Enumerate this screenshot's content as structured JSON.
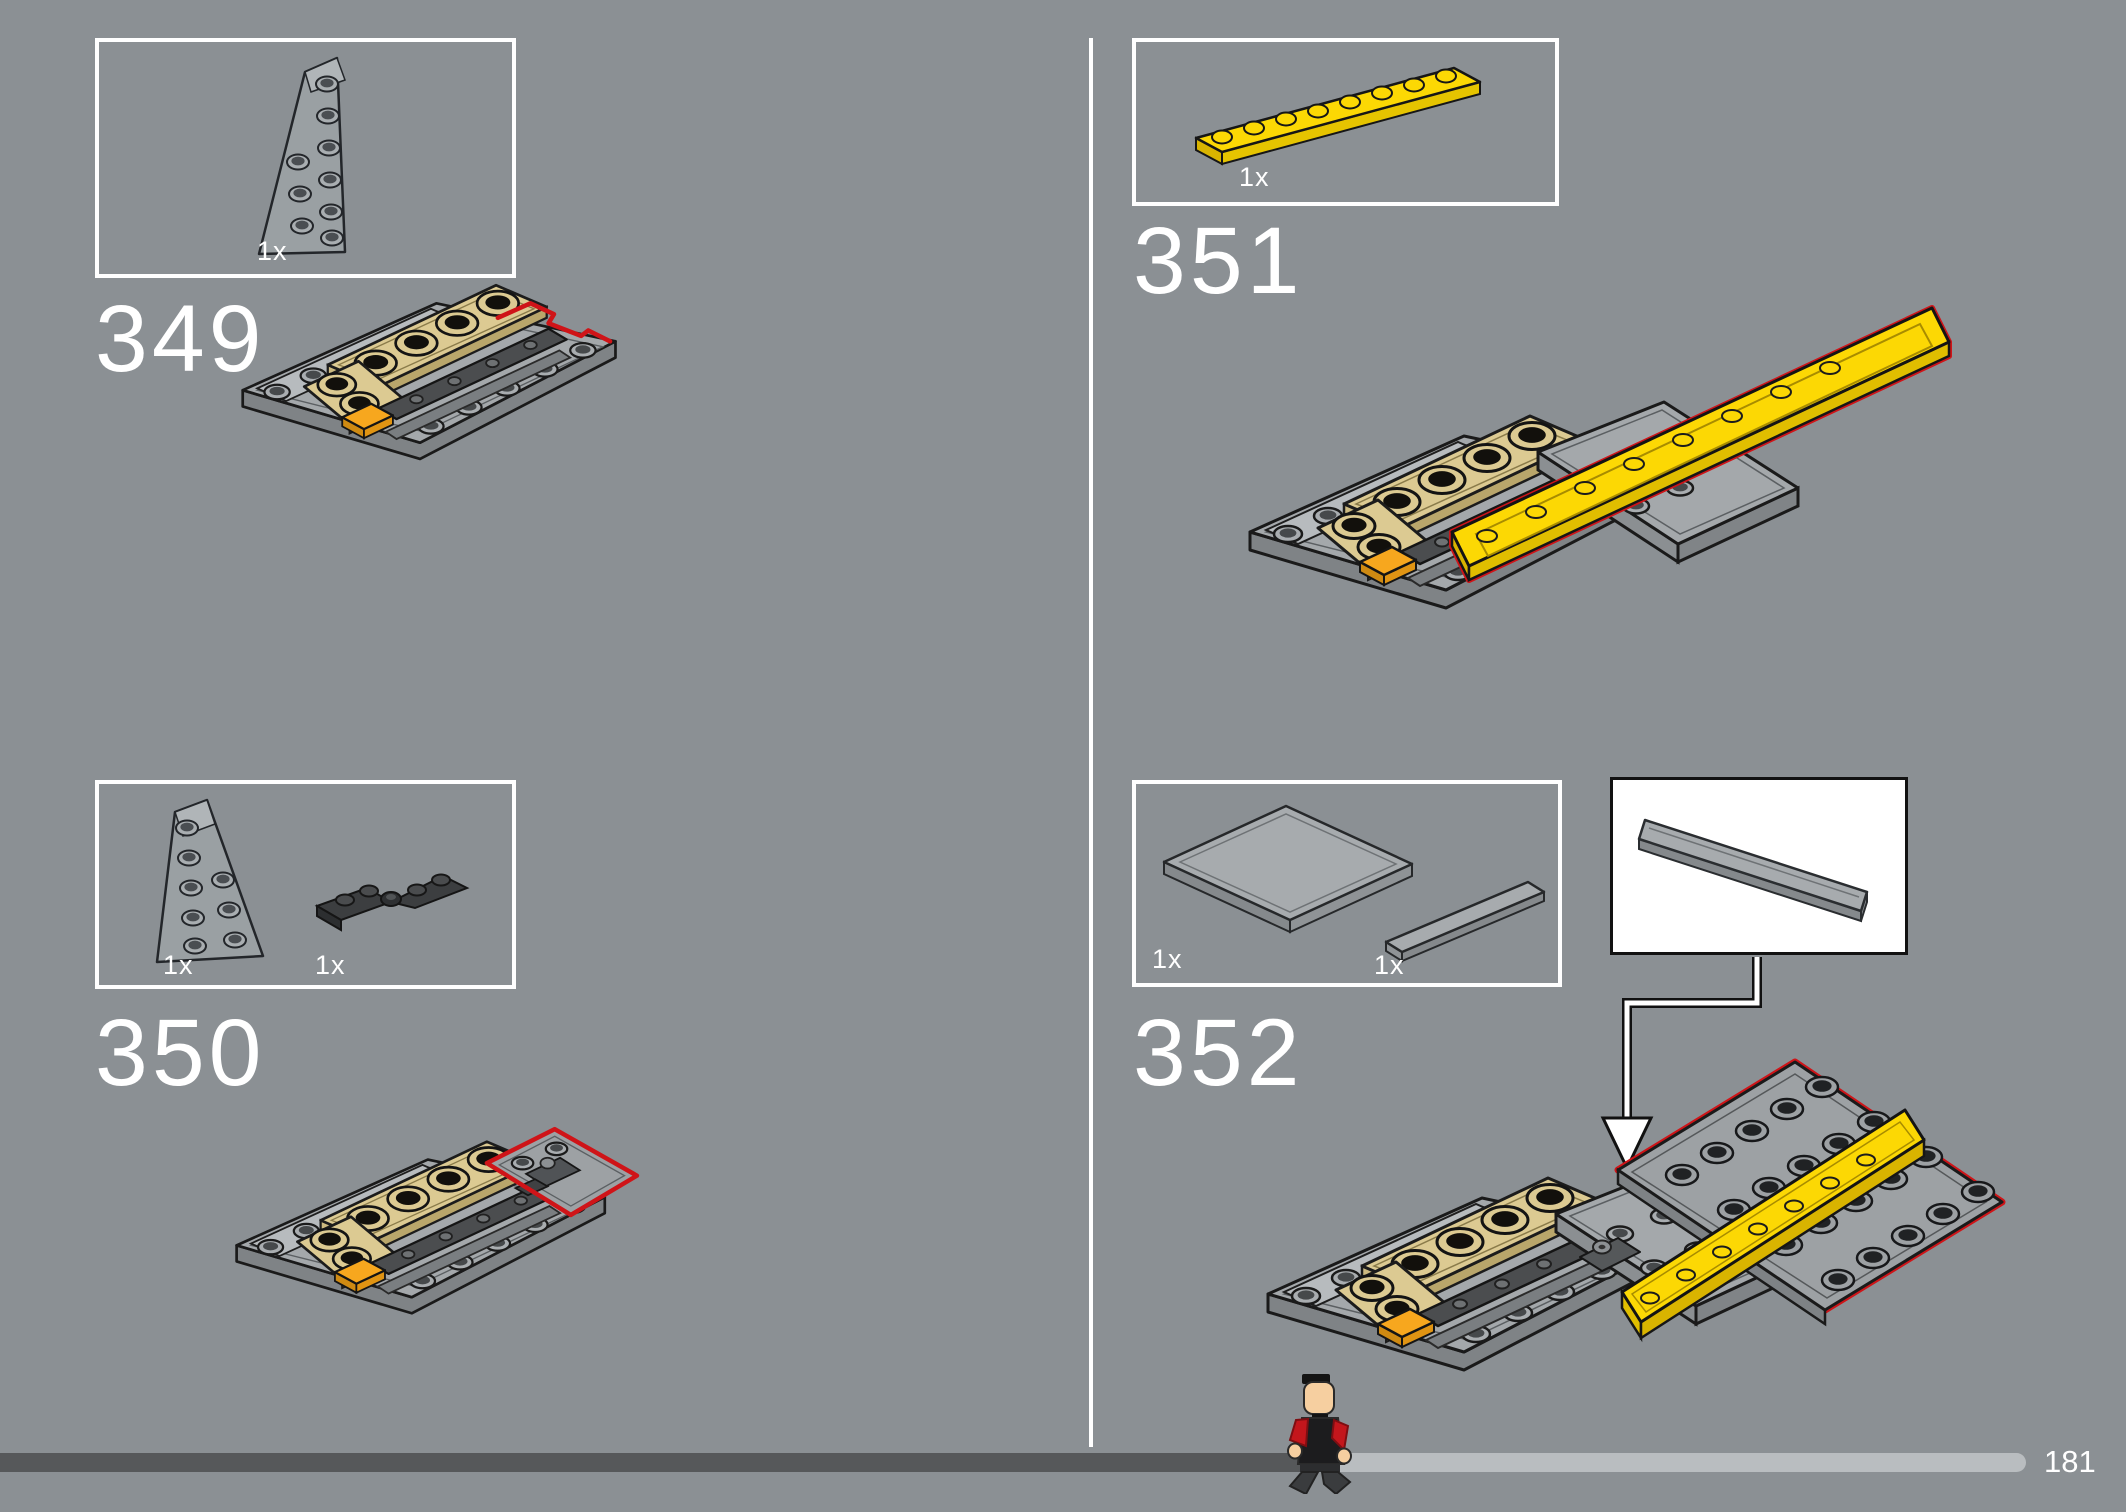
{
  "page": {
    "background": "#8b9094"
  },
  "colors": {
    "highlight_red": "#cf1418",
    "part_yellow": "#fcd804",
    "part_tan": "#dcca92",
    "part_orange": "#f7a71e",
    "part_gray": "#a4a8ab",
    "part_dark_gray": "#4b4d4f",
    "box_border_white": "#ffffff",
    "bar_dark": "#56585a",
    "bar_light": "#b9bdc0"
  },
  "steps": {
    "s349": {
      "number": "349",
      "parts": [
        {
          "qty": "1x",
          "piece": "wedge-plate-6x3-left-gray"
        }
      ]
    },
    "s350": {
      "number": "350",
      "parts": [
        {
          "qty": "1x",
          "piece": "wedge-plate-6x3-right-gray"
        },
        {
          "qty": "1x",
          "piece": "hinge-plates-dark-gray"
        }
      ]
    },
    "s351": {
      "number": "351",
      "parts": [
        {
          "qty": "1x",
          "piece": "plate-1x8-yellow"
        }
      ]
    },
    "s352": {
      "number": "352",
      "parts": [
        {
          "qty": "1x",
          "piece": "tile-6x6-gray"
        },
        {
          "qty": "1x",
          "piece": "tile-1x6-gray"
        }
      ],
      "callout": {
        "piece": "tile-1x6-gray"
      }
    }
  },
  "progress": {
    "page_label": "181",
    "completed_fraction": 0.65
  }
}
